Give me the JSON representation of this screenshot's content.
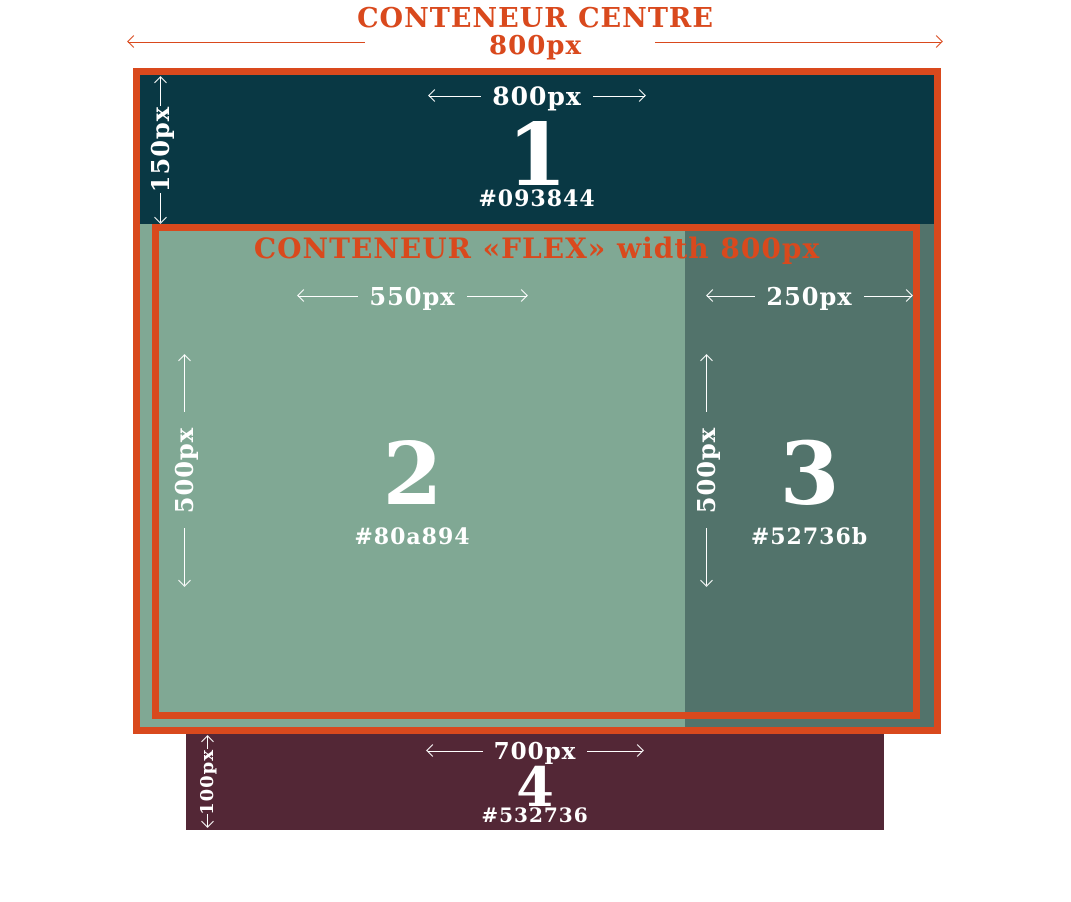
{
  "header": {
    "title": "CONTENEUR CENTRE",
    "width_label": "800px"
  },
  "box1": {
    "width_label": "800px",
    "height_label": "150px",
    "number": "1",
    "hex_label": "#093844"
  },
  "flex_container": {
    "title": "CONTENEUR «FLEX» width 800px"
  },
  "box2": {
    "width_label": "550px",
    "height_label": "500px",
    "number": "2",
    "hex_label": "#80a894"
  },
  "box3": {
    "width_label": "250px",
    "height_label": "500px",
    "number": "3",
    "hex_label": "#52736b"
  },
  "box4": {
    "width_label": "700px",
    "height_label": "100px",
    "number": "4",
    "hex_label": "#532736"
  },
  "colors": {
    "accent_orange": "#d9491d",
    "box1": "#093844",
    "box2": "#80a894",
    "box3": "#52736b",
    "box4": "#532736",
    "label_text": "#ffffff",
    "background": "#ffffff"
  }
}
